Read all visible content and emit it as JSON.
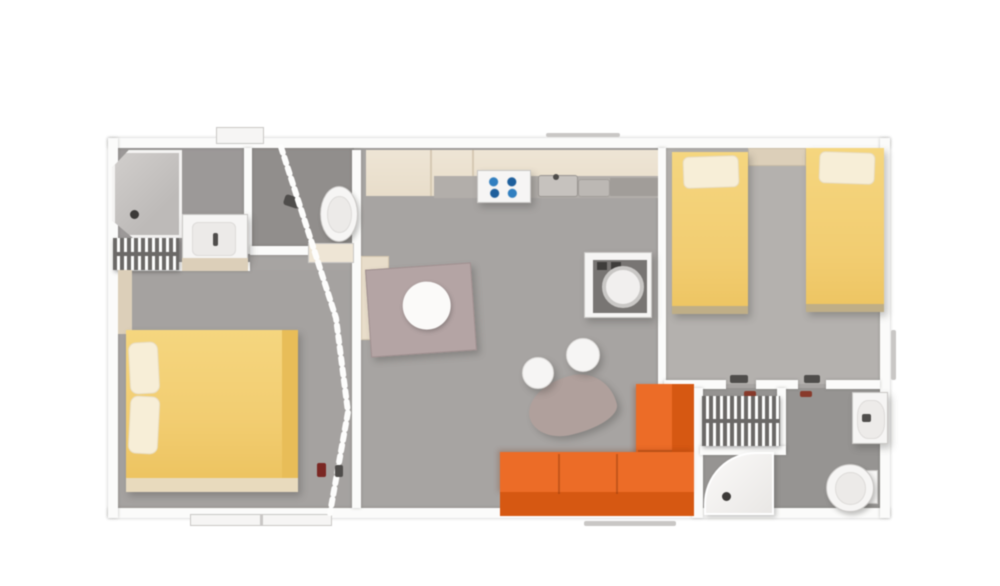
{
  "palette": {
    "background": "#ffffff",
    "wall": "#fbfbfa",
    "wall_edge": "#d7d5d3",
    "floor_main": "#a7a4a2",
    "floor_bath1": "#9c9998",
    "floor_wc": "#918e8c",
    "floor_twin": "#b4b1ae",
    "floor_bath2": "#969492",
    "floor_master": "#a5a2a0",
    "cabinet_beige": "#e8ddc9",
    "cabinet_beige_light": "#eee5d4",
    "cabinet_beige_dark": "#dccfb8",
    "worktop_grey": "#b2aeaa",
    "worktop_grey_dark": "#a19d99",
    "bed_yellow": "#f3cd6e",
    "bed_yellow_light": "#f6d67c",
    "bed_yellow_dark": "#e9bd55",
    "pillow_cream": "#f7eed6",
    "bed_frame": "#e8dabc",
    "bed_frame_dark": "#bfae86",
    "sofa_orange": "#ef6b24",
    "sofa_orange_dark": "#d9570f",
    "table_mauve": "#b4a4a4",
    "pebble_mauve": "#b0a09c",
    "radiator_grey": "#6b6967",
    "fixture_white": "#f6f5f4",
    "shower_grey": "#c7c4c2",
    "hob_blue": "#2f7fc2",
    "hob_blue_dark": "#1c5f9e",
    "handle_red": "#7c2622",
    "handle_rust": "#8a3a2a",
    "handle_dark": "#4f4d4b",
    "window_line": "#c9c7c5",
    "appliance_panel": "#787573"
  },
  "rooms": [
    {
      "name": "bathroom-1"
    },
    {
      "name": "wc"
    },
    {
      "name": "master-bedroom"
    },
    {
      "name": "kitchen-dining"
    },
    {
      "name": "living-area"
    },
    {
      "name": "twin-bedroom"
    },
    {
      "name": "bathroom-2"
    }
  ],
  "furniture": [
    {
      "name": "corner-shower-1"
    },
    {
      "name": "towel-radiator-1"
    },
    {
      "name": "vanity-sink-1"
    },
    {
      "name": "toilet-1"
    },
    {
      "name": "accordion-door"
    },
    {
      "name": "double-bed"
    },
    {
      "name": "kitchen-cabinets"
    },
    {
      "name": "gas-hob"
    },
    {
      "name": "kitchen-sink"
    },
    {
      "name": "washing-machine"
    },
    {
      "name": "dining-table"
    },
    {
      "name": "coffee-table"
    },
    {
      "name": "pouf-1"
    },
    {
      "name": "pouf-2"
    },
    {
      "name": "corner-sofa"
    },
    {
      "name": "single-bed-1"
    },
    {
      "name": "single-bed-2"
    },
    {
      "name": "bedside-shelf"
    },
    {
      "name": "towel-radiator-2"
    },
    {
      "name": "corner-shower-2"
    },
    {
      "name": "washbasin-2"
    },
    {
      "name": "toilet-2"
    }
  ]
}
